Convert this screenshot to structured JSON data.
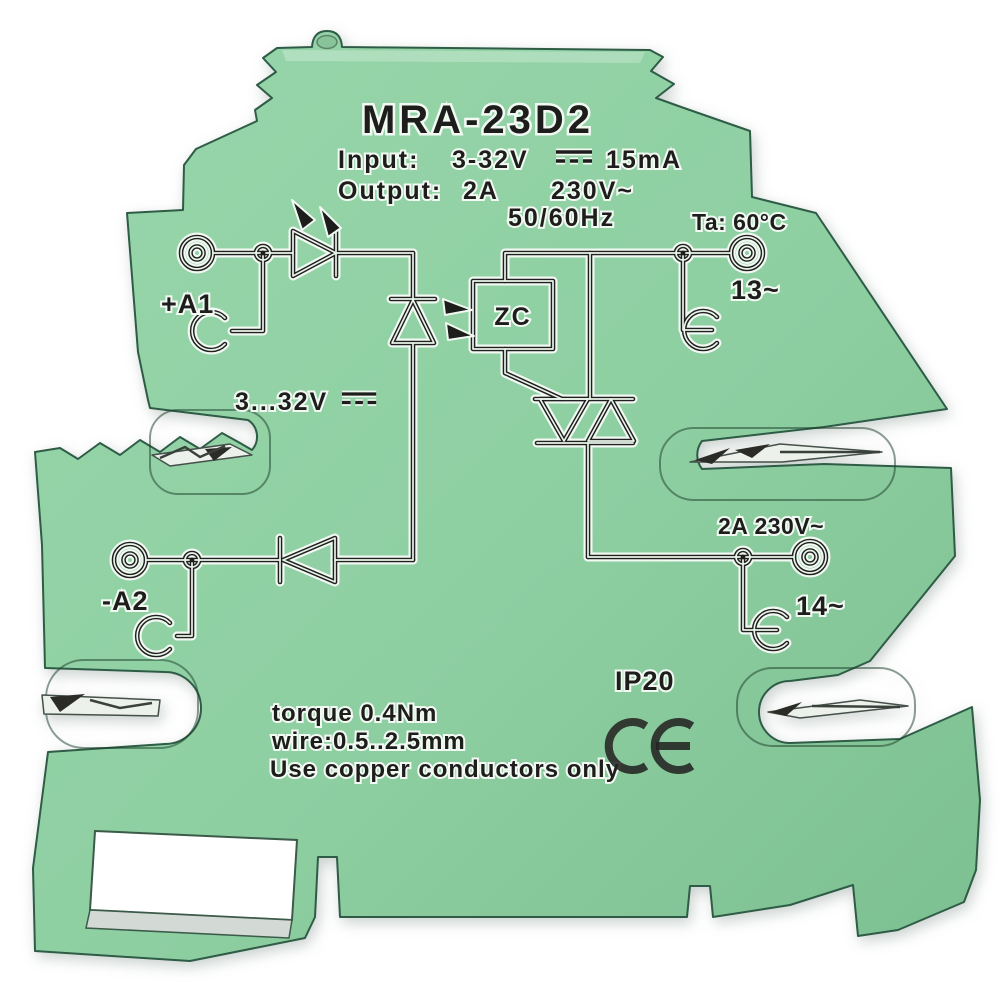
{
  "product": {
    "model": "MRA-23D2",
    "specs": {
      "input_label": "Input:",
      "input_voltage": "3-32V",
      "input_current": "15mA",
      "output_label": "Output:",
      "output_current": "2A",
      "output_voltage": "230V~",
      "output_frequency": "50/60Hz",
      "ambient_temperature": "Ta: 60°C"
    },
    "schematic": {
      "zc_label": "ZC",
      "input_range": "3...32V",
      "output_rating": "2A 230V~"
    },
    "terminals": {
      "input_positive": "+A1",
      "input_negative": "-A2",
      "output_13": "13~",
      "output_14": "14~"
    },
    "markings": {
      "ip_rating": "IP20",
      "ce_mark": "CE",
      "torque": "torque 0.4Nm",
      "wire": "wire:0.5..2.5mm",
      "copper": "Use copper conductors only"
    },
    "icons": {
      "dc_symbol": "⎓"
    },
    "colors": {
      "body_green": "#8ecfa2",
      "body_green_dark": "#7cbf90",
      "edge": "#2e5c46",
      "ink": "#1d1d1b",
      "metal": "#edf1ec",
      "background": "#ffffff"
    }
  }
}
